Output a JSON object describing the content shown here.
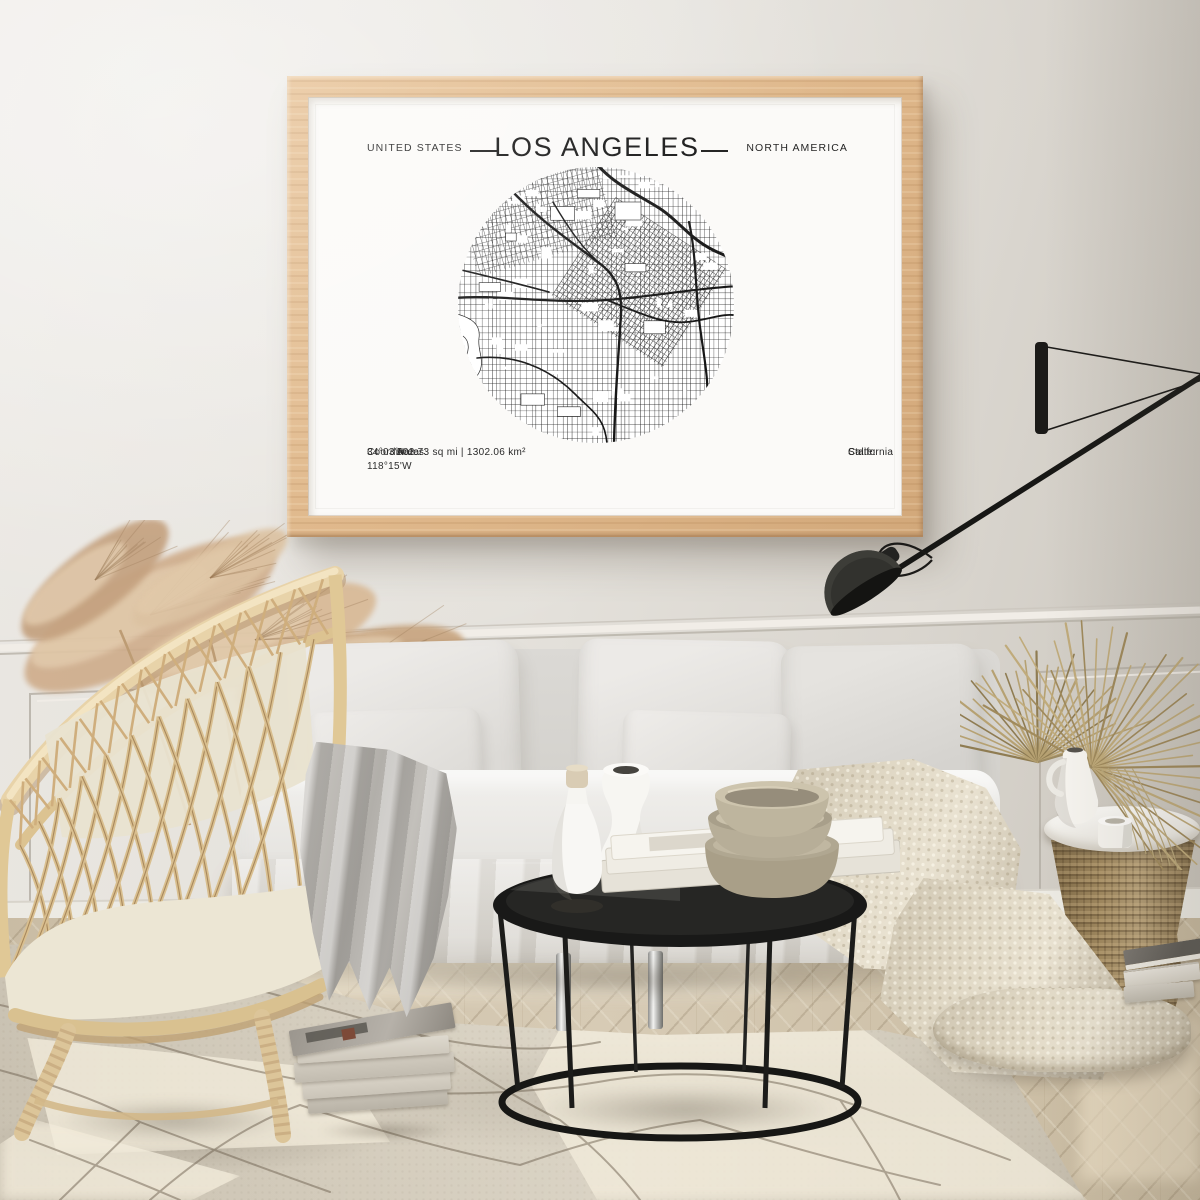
{
  "poster": {
    "country": "UNITED STATES",
    "title": "LOS ANGELES",
    "continent": "NORTH AMERICA",
    "footer": {
      "coordinates_label": "Coordinates:",
      "coordinates_value": "34°03'N 118°15'W",
      "area_label": "Area:",
      "area_value": "502.73 sq mi | 1302.06 km²",
      "state_label": "State:",
      "state_value": "California"
    }
  },
  "colors": {
    "frame_wood": "#e2bc92",
    "wall": "#e4e1db",
    "poster_paper": "#fbfaf8",
    "map_ink": "#1c1c1c",
    "lamp_black": "#1b1a18",
    "rattan": "#dcc599",
    "rug": "#d8d1c2",
    "floor_wood": "#cdc0a9",
    "blanket_knit": "#e0d8c5",
    "throw_grey": "#b2afaa"
  }
}
